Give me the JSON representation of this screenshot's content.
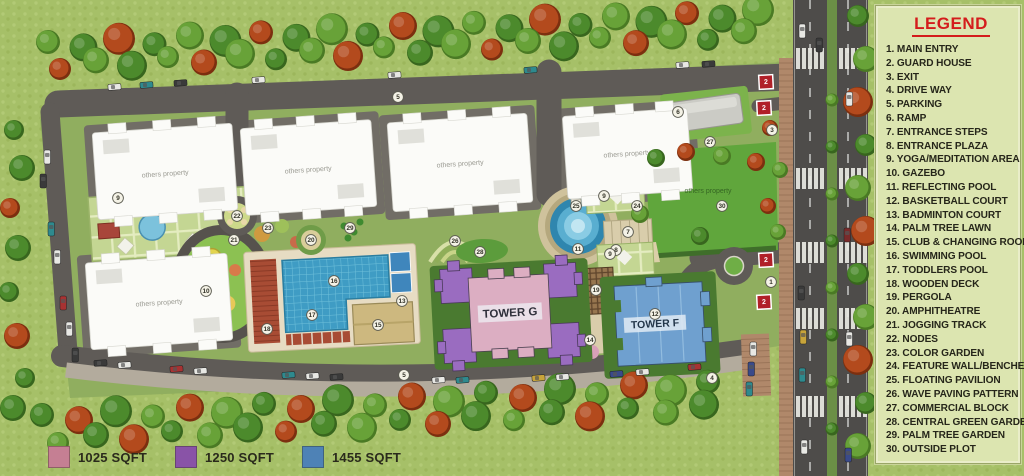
{
  "legend": {
    "title": "LEGEND",
    "items": [
      "1. MAIN ENTRY",
      "2. GUARD HOUSE",
      "3. EXIT",
      "4. DRIVE WAY",
      "5. PARKING",
      "6. RAMP",
      "7. ENTRANCE STEPS",
      "8. ENTRANCE PLAZA",
      "9. YOGA/MEDITATION AREA",
      "10. GAZEBO",
      "11. REFLECTING POOL",
      "12. BASKETBALL COURT",
      "13. BADMINTON COURT",
      "14. PALM TREE LAWN",
      "15. CLUB & CHANGING ROOM",
      "16. SWIMMING POOL",
      "17. TODDLERS POOL",
      "18. WOODEN DECK",
      "19. PERGOLA",
      "20. AMPHITHEATRE",
      "21. JOGGING TRACK",
      "22. NODES",
      "23. COLOR GARDEN",
      "24. FEATURE WALL/BENCHES",
      "25. FLOATING PAVILION",
      "26. WAVE PAVING PATTERN",
      "27. COMMERCIAL BLOCK",
      "28. CENTRAL GREEN GARDEN",
      "29. PALM TREE GARDEN",
      "30. OUTSIDE PLOT"
    ]
  },
  "sqft_legend": [
    {
      "label": "1025 SQFT",
      "color": "#c57f93"
    },
    {
      "label": "1250 SQFT",
      "color": "#8953a7"
    },
    {
      "label": "1455 SQFT",
      "color": "#4e82b6"
    }
  ],
  "map": {
    "others_property_label": "others property",
    "towers": [
      {
        "name": "TOWER G"
      },
      {
        "name": "TOWER F"
      }
    ],
    "guard_label": "2",
    "guard_houses": [
      {
        "x": 766,
        "y": 82
      },
      {
        "x": 764,
        "y": 108
      },
      {
        "x": 766,
        "y": 260
      },
      {
        "x": 764,
        "y": 302
      }
    ],
    "markers": [
      {
        "n": "1",
        "x": 771,
        "y": 282
      },
      {
        "n": "3",
        "x": 772,
        "y": 130
      },
      {
        "n": "4",
        "x": 712,
        "y": 378
      },
      {
        "n": "5",
        "x": 398,
        "y": 97
      },
      {
        "n": "5",
        "x": 404,
        "y": 375
      },
      {
        "n": "6",
        "x": 678,
        "y": 112
      },
      {
        "n": "7",
        "x": 628,
        "y": 232
      },
      {
        "n": "8",
        "x": 616,
        "y": 250
      },
      {
        "n": "9",
        "x": 118,
        "y": 198
      },
      {
        "n": "9",
        "x": 604,
        "y": 196
      },
      {
        "n": "9",
        "x": 610,
        "y": 254
      },
      {
        "n": "10",
        "x": 206,
        "y": 291
      },
      {
        "n": "11",
        "x": 578,
        "y": 249
      },
      {
        "n": "12",
        "x": 655,
        "y": 314
      },
      {
        "n": "13",
        "x": 402,
        "y": 301
      },
      {
        "n": "14",
        "x": 590,
        "y": 340
      },
      {
        "n": "15",
        "x": 378,
        "y": 325
      },
      {
        "n": "16",
        "x": 334,
        "y": 281
      },
      {
        "n": "17",
        "x": 312,
        "y": 315
      },
      {
        "n": "18",
        "x": 267,
        "y": 329
      },
      {
        "n": "19",
        "x": 596,
        "y": 290
      },
      {
        "n": "20",
        "x": 311,
        "y": 240
      },
      {
        "n": "21",
        "x": 234,
        "y": 240
      },
      {
        "n": "22",
        "x": 237,
        "y": 216
      },
      {
        "n": "23",
        "x": 268,
        "y": 228
      },
      {
        "n": "24",
        "x": 637,
        "y": 206
      },
      {
        "n": "25",
        "x": 576,
        "y": 206
      },
      {
        "n": "26",
        "x": 455,
        "y": 241
      },
      {
        "n": "27",
        "x": 710,
        "y": 142
      },
      {
        "n": "28",
        "x": 480,
        "y": 252
      },
      {
        "n": "29",
        "x": 350,
        "y": 228
      },
      {
        "n": "30",
        "x": 722,
        "y": 206
      }
    ]
  },
  "colors": {
    "grass": "#a6c068",
    "road": "#5f5b57",
    "tower_g_pink": "#dcaec2",
    "tower_g_purple": "#9a6cc0",
    "tower_f_blue": "#6fa0cf",
    "guard_red": "#b02028",
    "legend_red": "#d41c1c",
    "pool_blue": "#3f9cc4"
  }
}
